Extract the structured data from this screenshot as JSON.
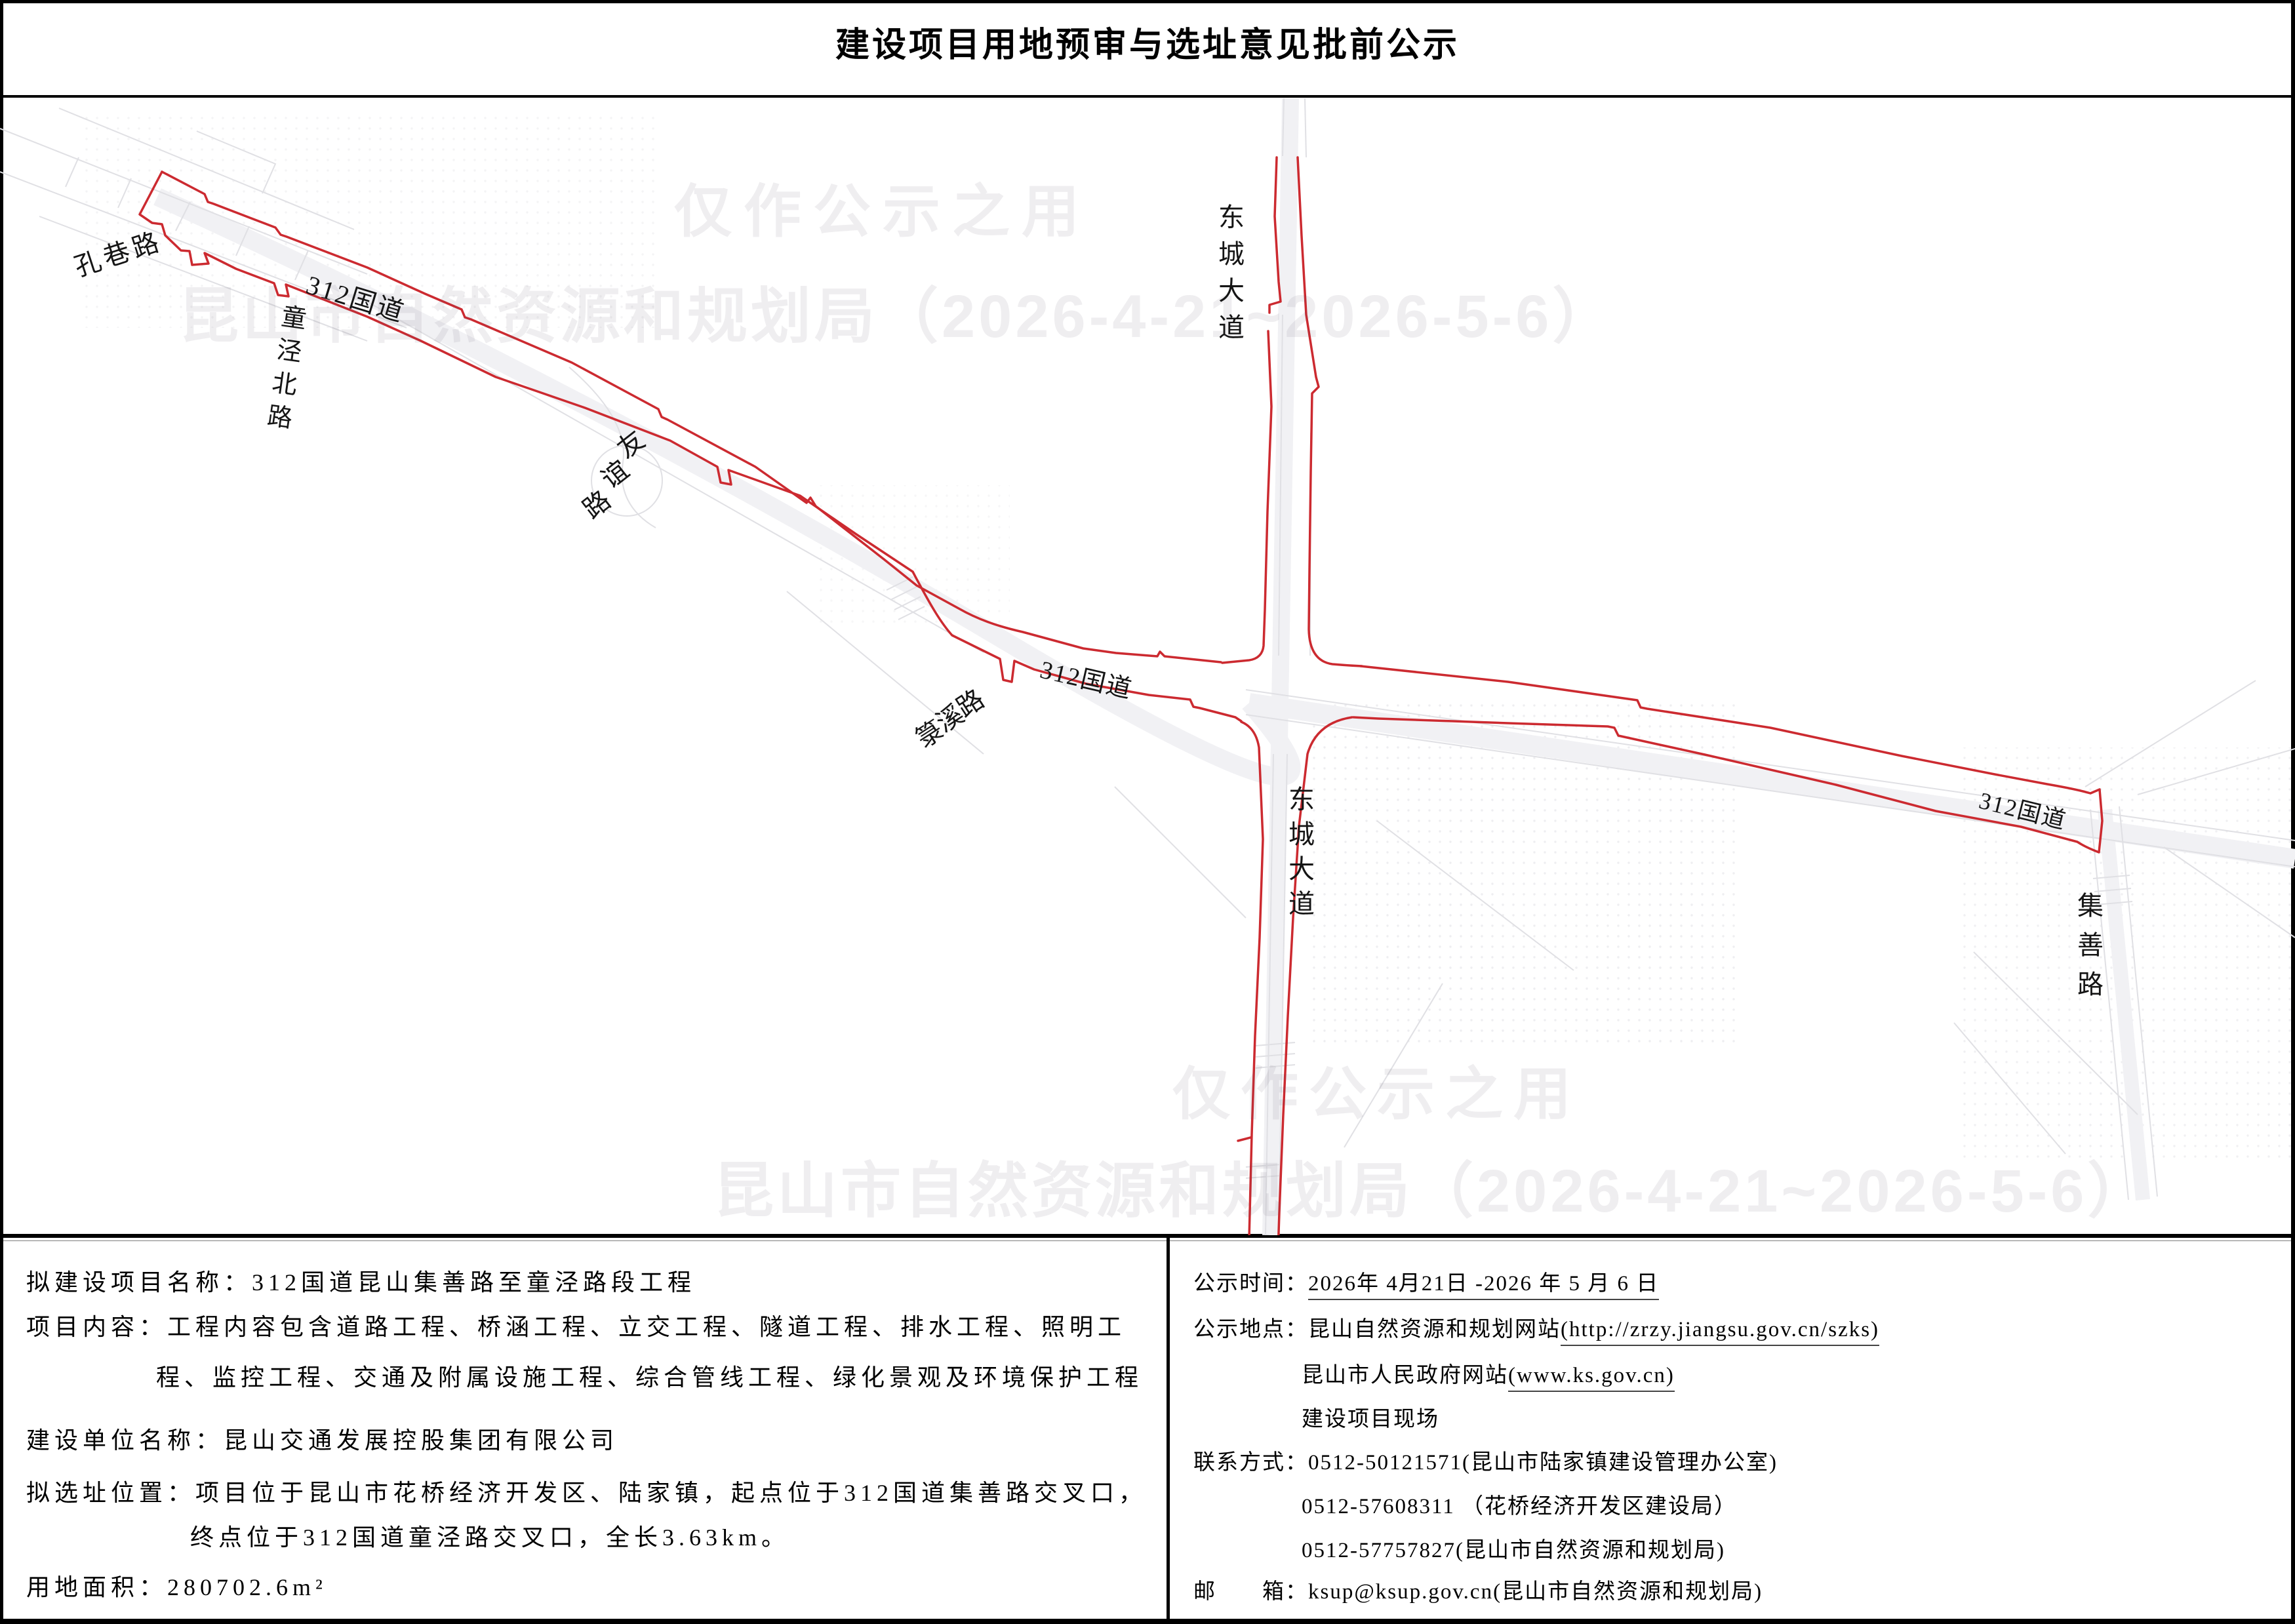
{
  "title": "建设项目用地预审与选址意见批前公示",
  "watermark": {
    "line1": "仅作公示之用",
    "line2": "昆山市自然资源和规划局（2026-4-21~2026-5-6）"
  },
  "map_labels": {
    "kongxiang_road": "孔巷路",
    "tongjingbei_road": "童泾北路",
    "g312_label_1": "312国道",
    "youyi_road": "友谊路",
    "dongcheng_avenue_north": "东城大道",
    "luxi_road": "箓溪路",
    "g312_label_2": "312国道",
    "dongcheng_avenue_south": "东城大道",
    "g312_label_3": "312国道",
    "jishan_road": "集善路"
  },
  "left_rows": [
    {
      "name": "project-name-row",
      "segs": [
        {
          "t": "拟建设项目名称：312国道昆山集善路至童泾路段工程"
        }
      ]
    },
    {
      "name": "project-content-row",
      "segs": [
        {
          "t": "项目内容：工程内容包含道路工程、桥涵工程、立交工程、隧道工程、排水工程、照明工"
        }
      ]
    },
    {
      "name": "project-content-row-2",
      "segs": [
        {
          "t": "程、监控工程、交通及附属设施工程、综合管线工程、绿化景观及环境保护工程"
        }
      ]
    },
    {
      "name": "construction-unit-row",
      "segs": [
        {
          "t": "建设单位名称：昆山交通发展控股集团有限公司"
        }
      ]
    },
    {
      "name": "site-location-row",
      "segs": [
        {
          "t": "拟选址位置：项目位于昆山市花桥经济开发区、陆家镇，起点位于312国道集善路交叉口，"
        }
      ]
    },
    {
      "name": "site-location-row-2",
      "segs": [
        {
          "t": "终点位于312国道童泾路交叉口，全长3.63km。"
        }
      ]
    },
    {
      "name": "land-area-row",
      "segs": [
        {
          "t": "用地面积：280702.6m²"
        }
      ]
    }
  ],
  "right_rows": [
    {
      "name": "notice-time-row",
      "segs": [
        {
          "t": "公示时间："
        },
        {
          "t": "2026年 4月21日 -2026 年 5 月 6 日",
          "u": true
        }
      ]
    },
    {
      "name": "notice-place-row",
      "segs": [
        {
          "t": "公示地点：昆山自然资源和规划网站"
        },
        {
          "t": "(http://zrzy.jiangsu.gov.cn/szks)",
          "u": true
        }
      ]
    },
    {
      "name": "notice-place-row-2",
      "segs": [
        {
          "t": "昆山市人民政府网站"
        },
        {
          "t": "(www.ks.gov.cn)",
          "u": true
        }
      ]
    },
    {
      "name": "notice-place-row-3",
      "segs": [
        {
          "t": "建设项目现场"
        }
      ]
    },
    {
      "name": "contact-row",
      "segs": [
        {
          "t": "联系方式：0512-50121571(昆山市陆家镇建设管理办公室)"
        }
      ]
    },
    {
      "name": "contact-row-2",
      "segs": [
        {
          "t": "0512-57608311 （花桥经济开发区建设局）"
        }
      ]
    },
    {
      "name": "contact-row-3",
      "segs": [
        {
          "t": "0512-57757827(昆山市自然资源和规划局)"
        }
      ]
    },
    {
      "name": "email-row",
      "segs": [
        {
          "t": "邮　　箱：ksup@ksup.gov.cn(昆山市自然资源和规划局)"
        }
      ]
    }
  ],
  "colors": {
    "outline_red": "#cc2a30",
    "border_black": "#000000",
    "clutter_gray": "#e0e0e4"
  }
}
